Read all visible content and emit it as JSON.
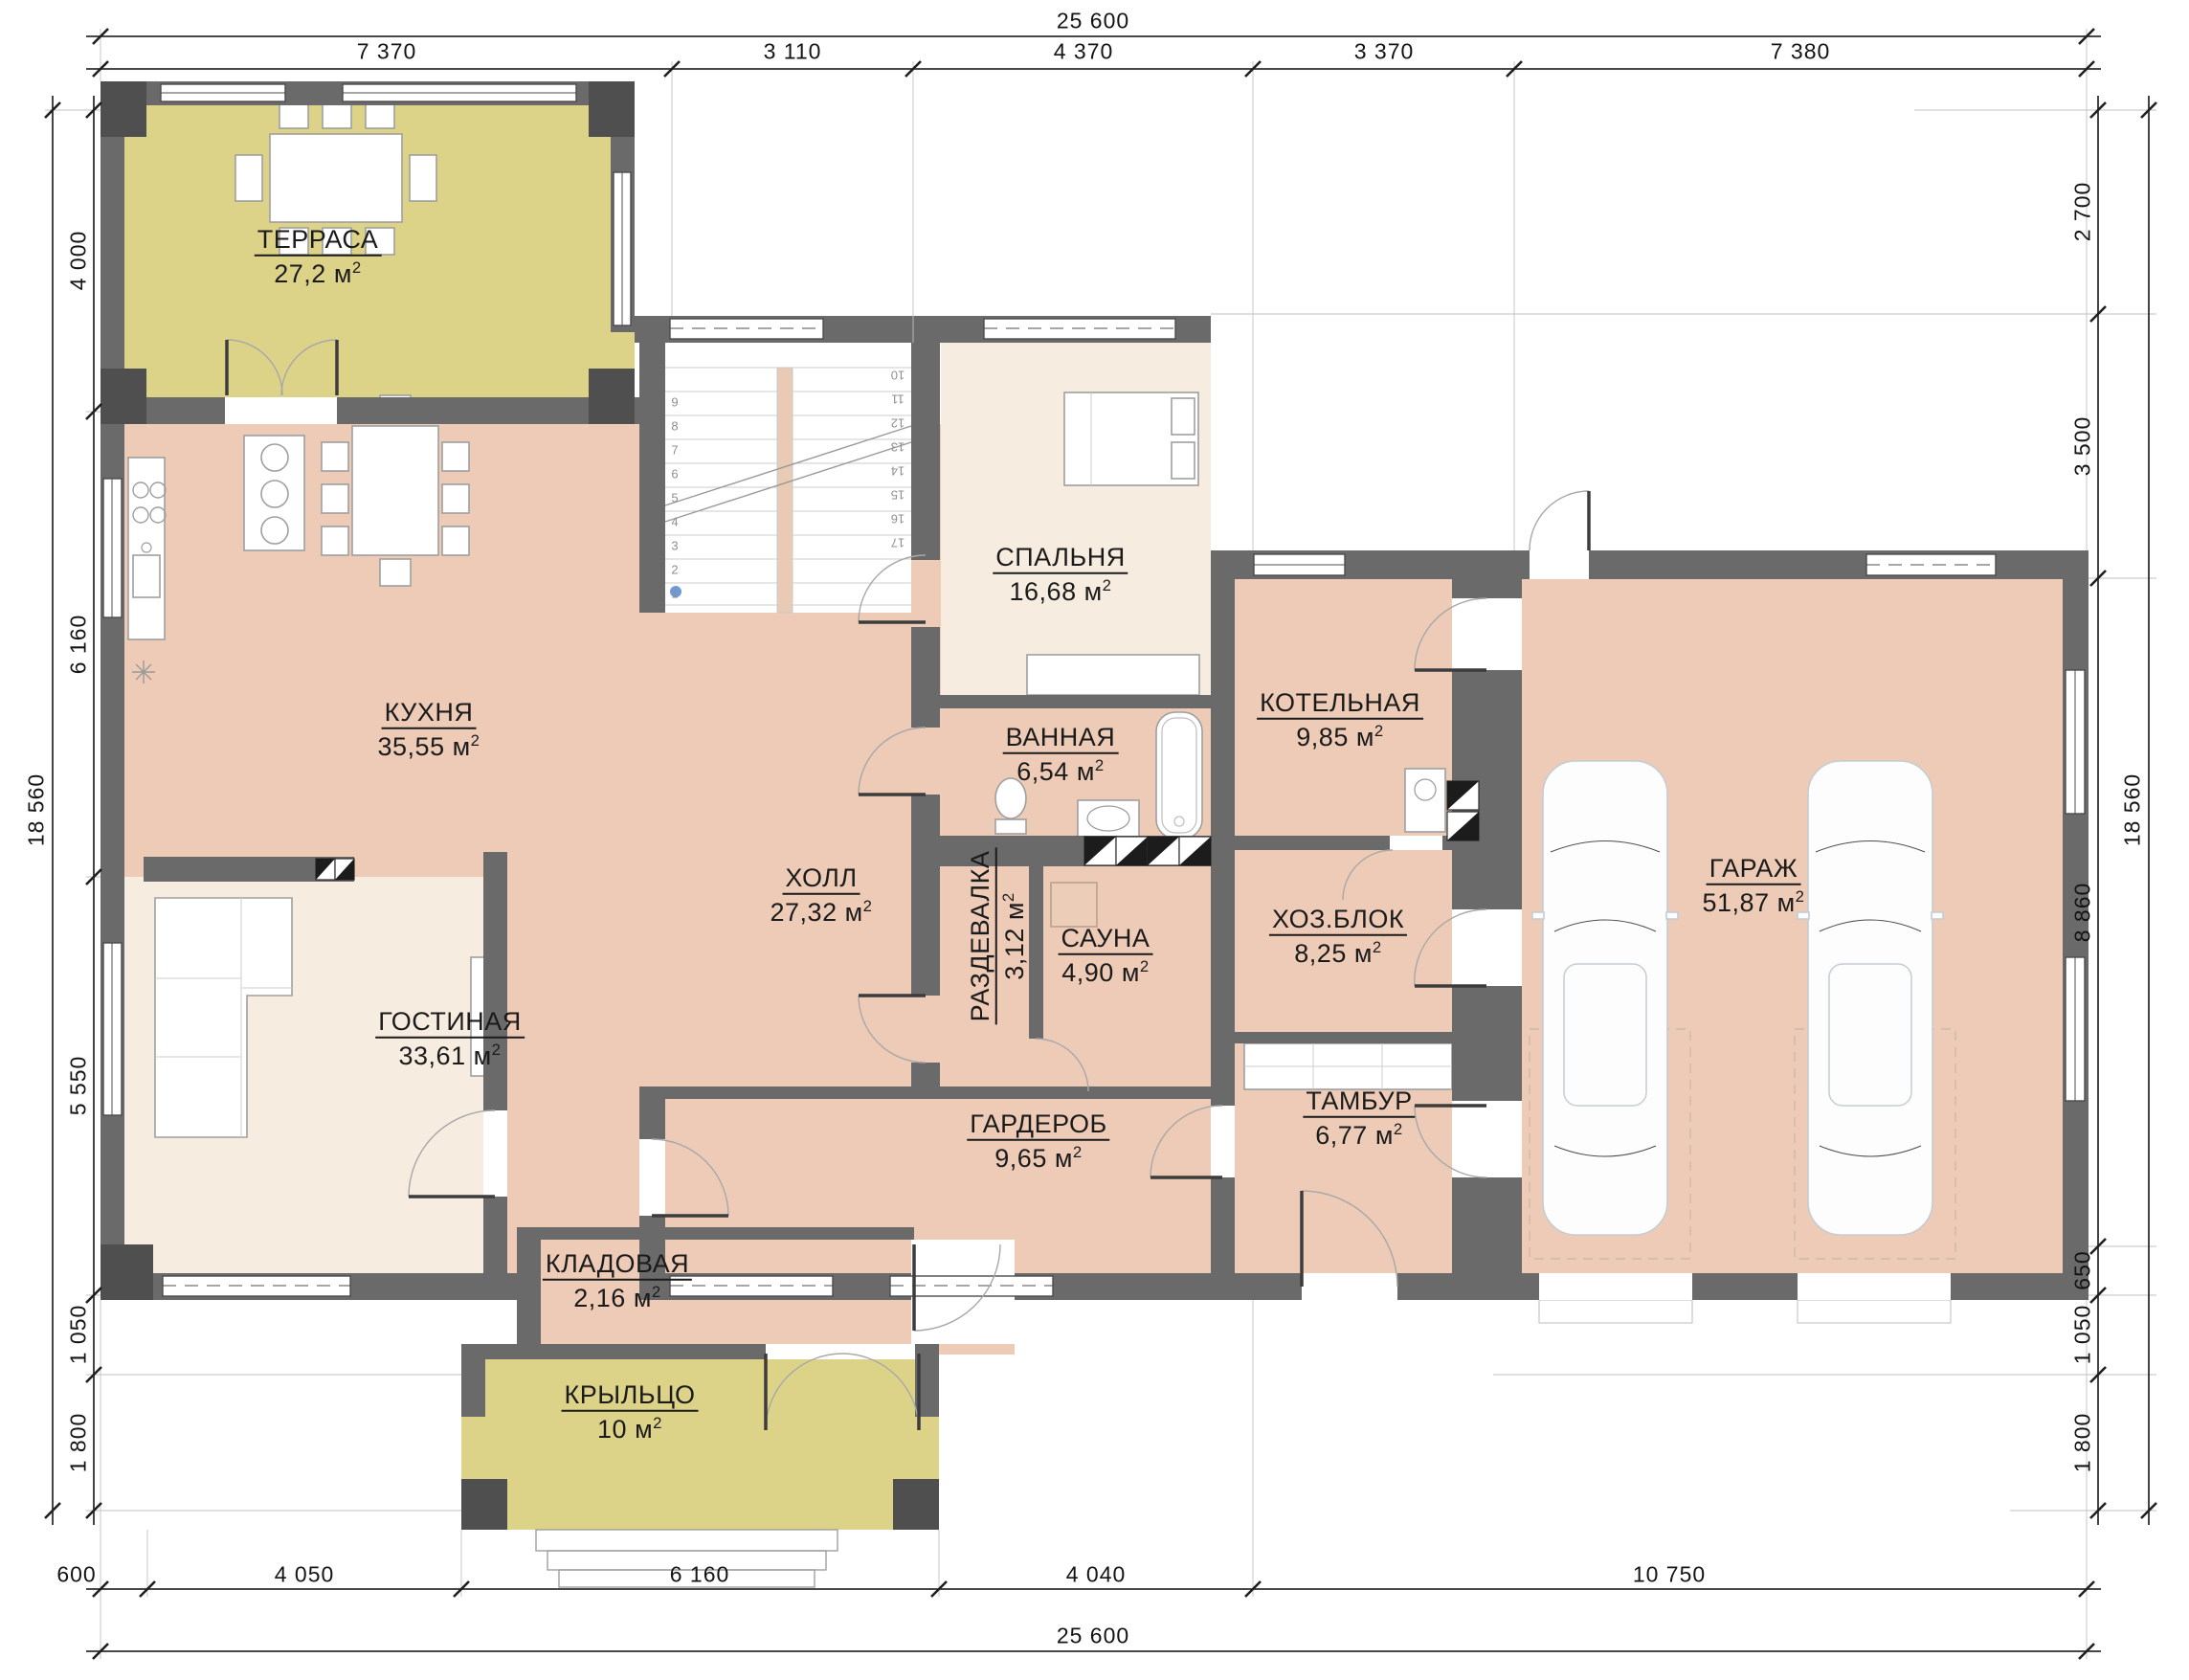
{
  "drawing_type": "floor-plan",
  "area_unit": {
    "base": "м",
    "exp": "2"
  },
  "rooms": [
    {
      "id": "terrasa",
      "name": "ТЕРРАСА",
      "area": "27,2"
    },
    {
      "id": "kuhnya",
      "name": "КУХНЯ",
      "area": "35,55"
    },
    {
      "id": "gostinaya",
      "name": "ГОСТИНАЯ",
      "area": "33,61"
    },
    {
      "id": "holl",
      "name": "ХОЛЛ",
      "area": "27,32"
    },
    {
      "id": "spalnya",
      "name": "СПАЛЬНЯ",
      "area": "16,68"
    },
    {
      "id": "vannaya",
      "name": "ВАННАЯ",
      "area": "6,54"
    },
    {
      "id": "razdevalka",
      "name": "РАЗДЕВАЛКА",
      "area": "3,12"
    },
    {
      "id": "sauna",
      "name": "САУНА",
      "area": "4,90"
    },
    {
      "id": "kotelnaya",
      "name": "КОТЕЛЬНАЯ",
      "area": "9,85"
    },
    {
      "id": "hozblok",
      "name": "ХОЗ.БЛОК",
      "area": "8,25"
    },
    {
      "id": "garazh",
      "name": "ГАРАЖ",
      "area": "51,87"
    },
    {
      "id": "garderob",
      "name": "ГАРДЕРОБ",
      "area": "9,65"
    },
    {
      "id": "tambur",
      "name": "ТАМБУР",
      "area": "6,77"
    },
    {
      "id": "kladovaya",
      "name": "КЛАДОВАЯ",
      "area": "2,16"
    },
    {
      "id": "kryltso",
      "name": "КРЫЛЬЦО",
      "area": "10"
    }
  ],
  "dimensions": {
    "top_total": "25 600",
    "top_segments": [
      "7 370",
      "3 110",
      "4 370",
      "3 370",
      "7 380"
    ],
    "left_total": "18 560",
    "left_segments": [
      "4 000",
      "6 160",
      "5 550",
      "1 050",
      "1 800"
    ],
    "right_segments": [
      "2 700",
      "3 500",
      "8 860",
      "650",
      "1 050",
      "1 800"
    ],
    "right_total": "18 560",
    "bottom_segments": [
      "600",
      "4 050",
      "6 160",
      "4 040",
      "10 750"
    ],
    "bottom_total": "25 600"
  },
  "stairs": {
    "left_numbers": [
      "1",
      "2",
      "3",
      "4",
      "5",
      "6",
      "7",
      "8",
      "9"
    ],
    "right_numbers": [
      "10",
      "11",
      "12",
      "13",
      "14",
      "15",
      "16",
      "17"
    ]
  },
  "colors": {
    "walls": "#6a6a6a",
    "pillars": "#4f4f4f",
    "room_pink": "#edcbb6",
    "room_cream": "#f6ecdf",
    "terrace_olive": "#dcd389"
  }
}
